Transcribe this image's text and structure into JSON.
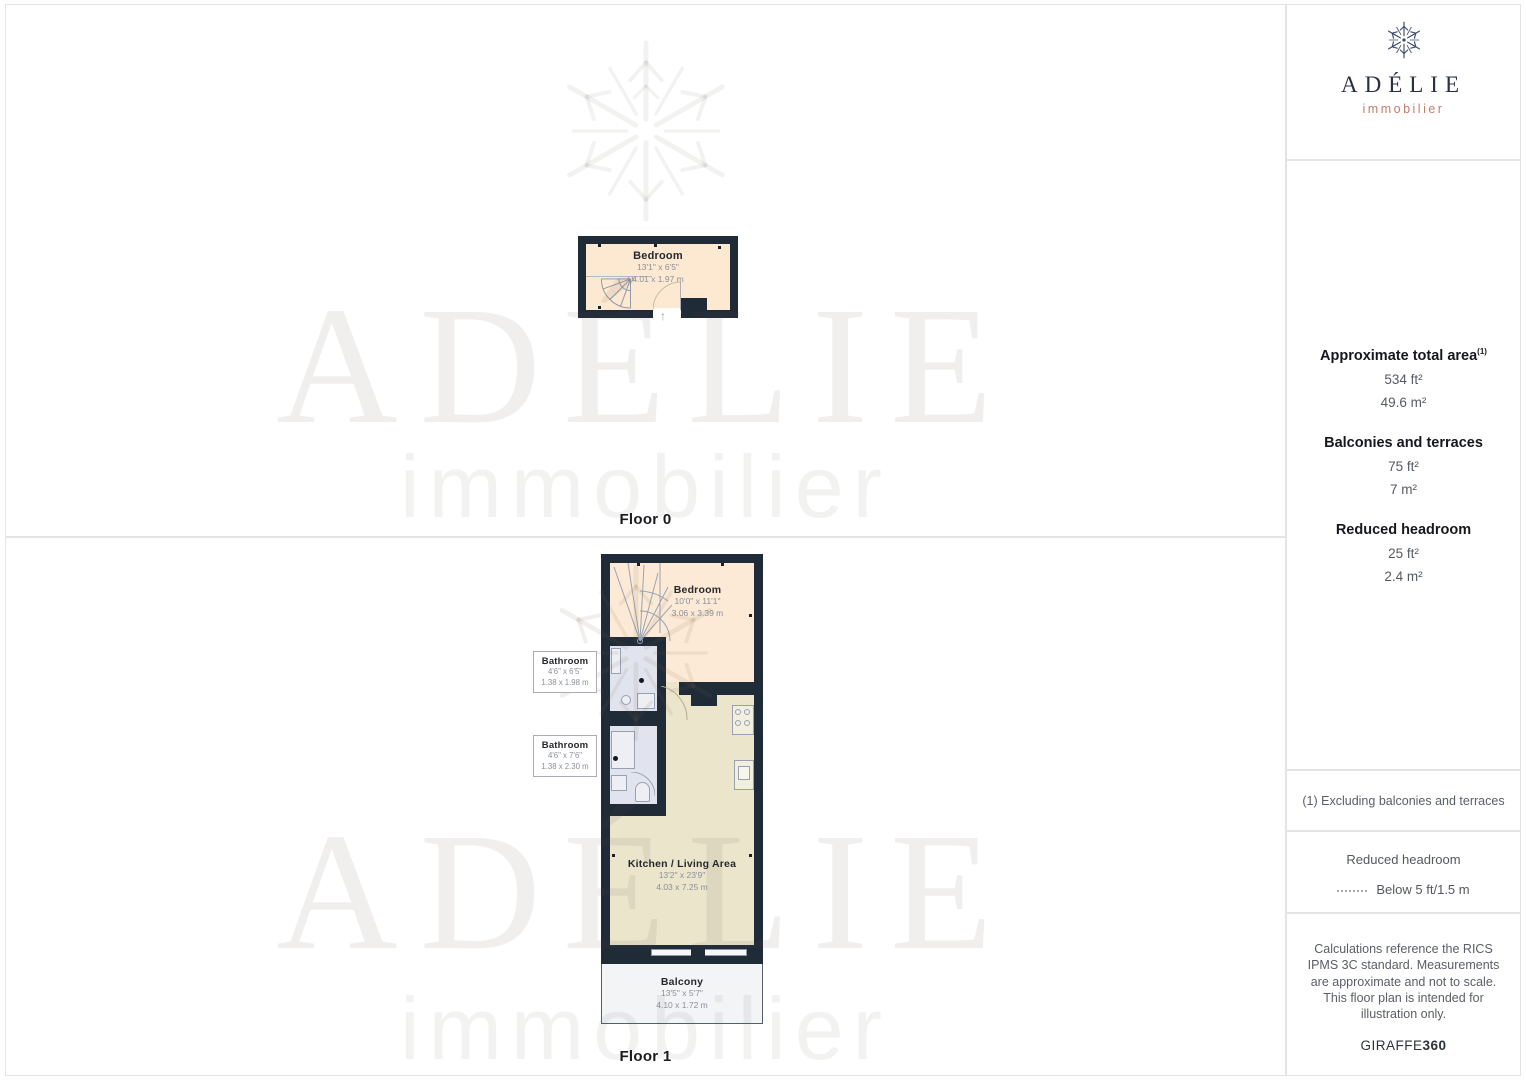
{
  "logo": {
    "name": "ADÉLIE",
    "tagline": "immobilier"
  },
  "watermark": {
    "name": "ADÉLIE",
    "tagline": "immobilier"
  },
  "colors": {
    "wall": "#202b38",
    "bedroom_floor": "#fcead6",
    "kitchen_floor": "#ebe5cc",
    "bathroom_floor": "#e1e4ee",
    "balcony_floor": "#f3f4f6",
    "logo_navy": "#2a3044",
    "logo_accent": "#c57c6d"
  },
  "floor0": {
    "label": "Floor 0",
    "bedroom": {
      "name": "Bedroom",
      "ft": "13'1\" x 6'5\"",
      "m": "4.01 x 1.97 m"
    }
  },
  "floor1": {
    "label": "Floor 1",
    "bedroom": {
      "name": "Bedroom",
      "ft": "10'0\" x 11'1\"",
      "m": "3.06 x 3.39 m"
    },
    "bathroom1": {
      "name": "Bathroom",
      "ft": "4'6\" x 6'5\"",
      "m": "1.38 x 1.98 m"
    },
    "bathroom2": {
      "name": "Bathroom",
      "ft": "4'6\" x 7'6\"",
      "m": "1.38 x 2.30 m"
    },
    "kitchen": {
      "name": "Kitchen / Living Area",
      "ft": "13'2\" x 23'9\"",
      "m": "4.03 x 7.25 m"
    },
    "balcony": {
      "name": "Balcony",
      "ft": "13'5\" x 5'7\"",
      "m": "4.10 x 1.72 m"
    }
  },
  "sidebar": {
    "total": {
      "title": "Approximate total area",
      "sup": "(1)",
      "ft": "534 ft²",
      "m": "49.6 m²"
    },
    "balconies": {
      "title": "Balconies and terraces",
      "ft": "75 ft²",
      "m": "7 m²"
    },
    "headroom": {
      "title": "Reduced headroom",
      "ft": "25 ft²",
      "m": "2.4 m²"
    },
    "footnote": "(1) Excluding balconies and terraces",
    "legend": {
      "title": "Reduced headroom",
      "label": "Below 5 ft/1.5 m"
    },
    "disclaimer": "Calculations reference the RICS IPMS 3C standard. Measurements are approximate and not to scale. This floor plan is intended for illustration only.",
    "credit": {
      "brand": "GIRAFFE",
      "suffix": "360"
    }
  }
}
